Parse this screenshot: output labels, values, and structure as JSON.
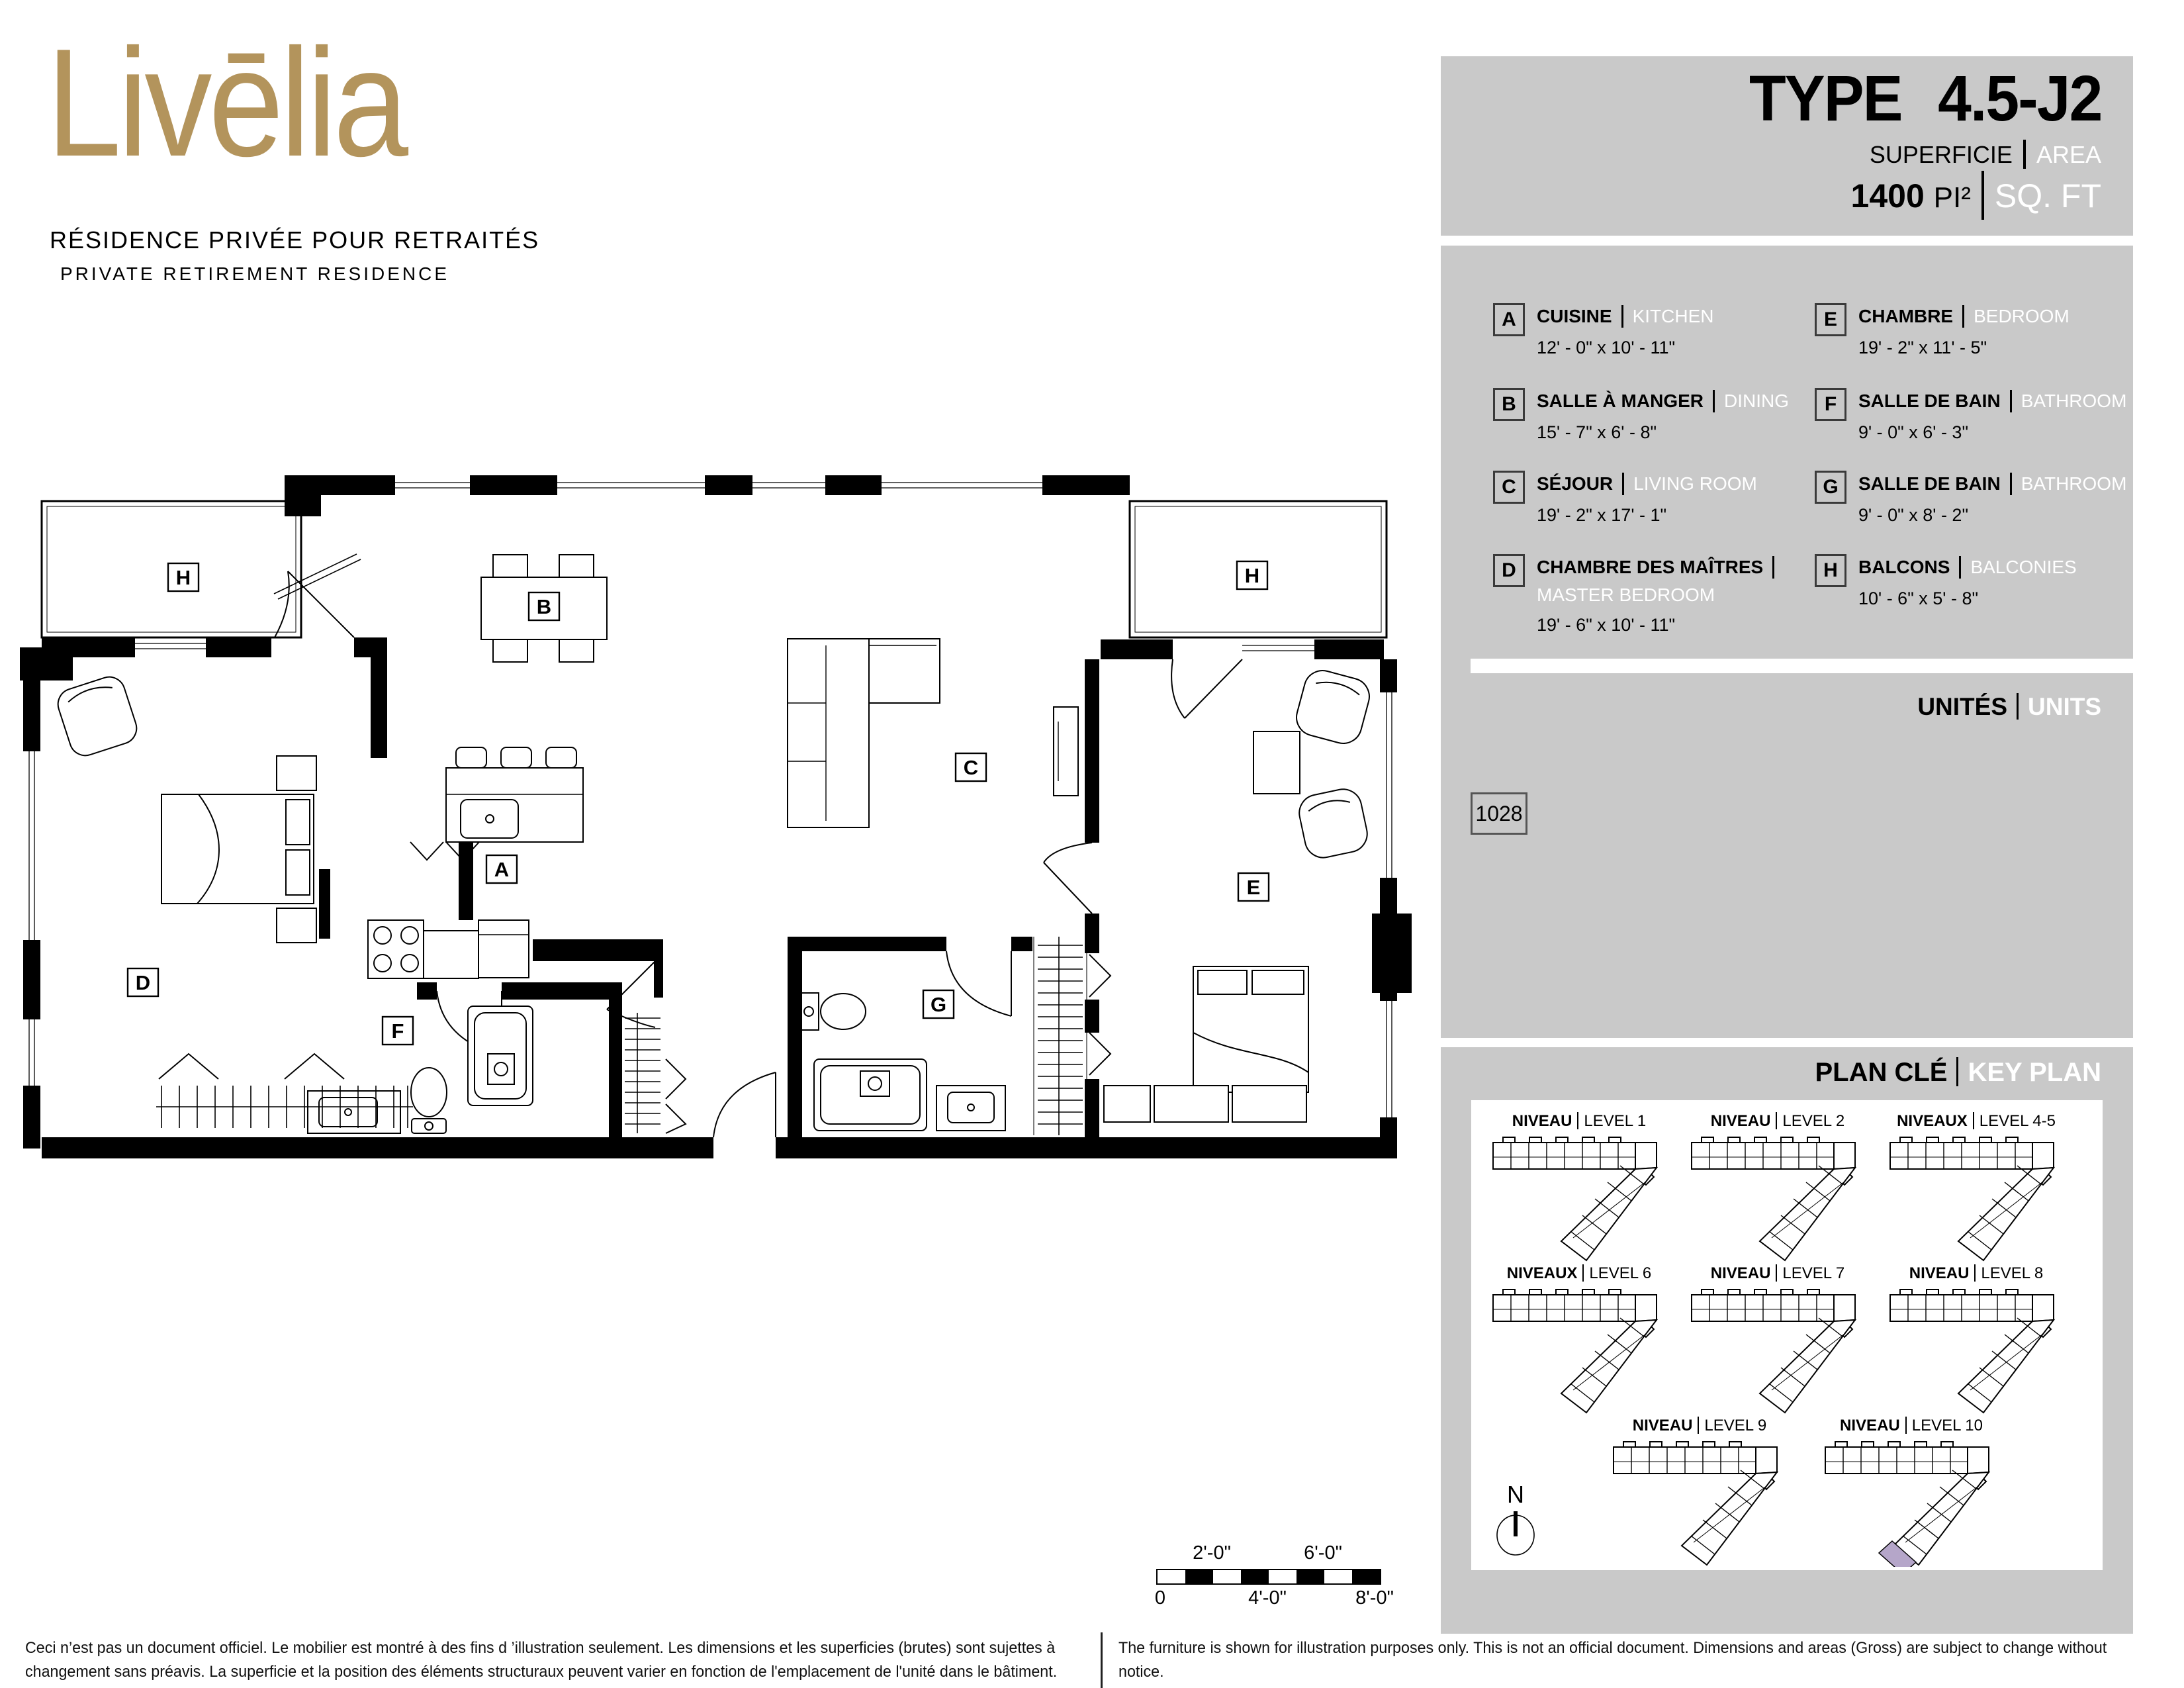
{
  "logo": {
    "wordmark": "Livēlia",
    "tagline_fr": "RÉSIDENCE PRIVÉE POUR RETRAITÉS",
    "tagline_en": "PRIVATE RETIREMENT RESIDENCE"
  },
  "header": {
    "type_label": "TYPE",
    "type_value": "4.5-J2",
    "area_label_fr": "SUPERFICIE",
    "area_label_en": "AREA",
    "area_value": "1400",
    "area_unit_fr": "PI²",
    "area_unit_en": "SQ. FT"
  },
  "legend": {
    "rows": [
      {
        "letter": "A",
        "fr": "CUISINE",
        "en": "KITCHEN",
        "dims": "12' - 0\" x 10' - 11\""
      },
      {
        "letter": "B",
        "fr": "SALLE À MANGER",
        "en": "DINING",
        "dims": "15' - 7\" x 6' - 8\""
      },
      {
        "letter": "C",
        "fr": "SÉJOUR",
        "en": "LIVING ROOM",
        "dims": "19' - 2\" x 17' - 1\""
      },
      {
        "letter": "D",
        "fr": "CHAMBRE DES MAÎTRES",
        "en": "MASTER BEDROOM",
        "dims": "19' - 6\" x 10' - 11\""
      },
      {
        "letter": "E",
        "fr": "CHAMBRE",
        "en": "BEDROOM",
        "dims": "19' - 2\" x 11' - 5\""
      },
      {
        "letter": "F",
        "fr": "SALLE DE BAIN",
        "en": "BATHROOM",
        "dims": "9' - 0\" x 6' - 3\""
      },
      {
        "letter": "G",
        "fr": "SALLE DE BAIN",
        "en": "BATHROOM",
        "dims": "9' - 0\" x 8' - 2\""
      },
      {
        "letter": "H",
        "fr": "BALCONS",
        "en": "BALCONIES",
        "dims": "10' - 6\" x 5' - 8\""
      }
    ]
  },
  "units": {
    "label_fr": "UNITÉS",
    "label_en": "UNITS",
    "numbers": [
      "1028"
    ]
  },
  "key_plan": {
    "title_fr": "PLAN CLÉ",
    "title_en": "KEY PLAN",
    "north_label": "N",
    "highlight_color": "#b5a6c9",
    "levels": [
      {
        "fr": "NIVEAU",
        "en": "LEVEL 1"
      },
      {
        "fr": "NIVEAU",
        "en": "LEVEL 2"
      },
      {
        "fr": "NIVEAUX",
        "en": "LEVEL 4-5"
      },
      {
        "fr": "NIVEAUX",
        "en": "LEVEL 6"
      },
      {
        "fr": "NIVEAU",
        "en": "LEVEL 7"
      },
      {
        "fr": "NIVEAU",
        "en": "LEVEL 8"
      },
      {
        "fr": "NIVEAU",
        "en": "LEVEL 9"
      },
      {
        "fr": "NIVEAU",
        "en": "LEVEL 10"
      }
    ]
  },
  "plan": {
    "labels": {
      "h_left": "H",
      "b": "B",
      "h_right": "H",
      "c": "C",
      "a": "A",
      "e": "E",
      "d": "D",
      "f": "F",
      "g": "G"
    }
  },
  "scale_bar": {
    "above_1": "2'-0\"",
    "above_2": "6'-0\"",
    "below_0": "0",
    "below_4": "4'-0\"",
    "below_8": "8'-0\""
  },
  "disclaimer": {
    "fr_line1": "Ceci n’est pas un document officiel.  Le mobilier est montré à des fins d ’illustration seulement.  Les dimensions et les superficies (brutes) sont sujettes à",
    "fr_line2": "changement sans préavis. La superficie et la position des éléments structuraux peuvent varier en fonction de l'emplacement de l'unité dans le bâtiment.",
    "en_line1": "The furniture is shown for illustration purposes only.  This is not an official document.  Dimensions and areas (Gross) are subject to change without notice.",
    "en_line2": "Area and position of structural elements may vary depending of location of unit in building."
  },
  "colors": {
    "brand_gold": "#b3945c",
    "panel_gray": "#c9c9c9",
    "highlight_purple": "#b5a6c9"
  }
}
